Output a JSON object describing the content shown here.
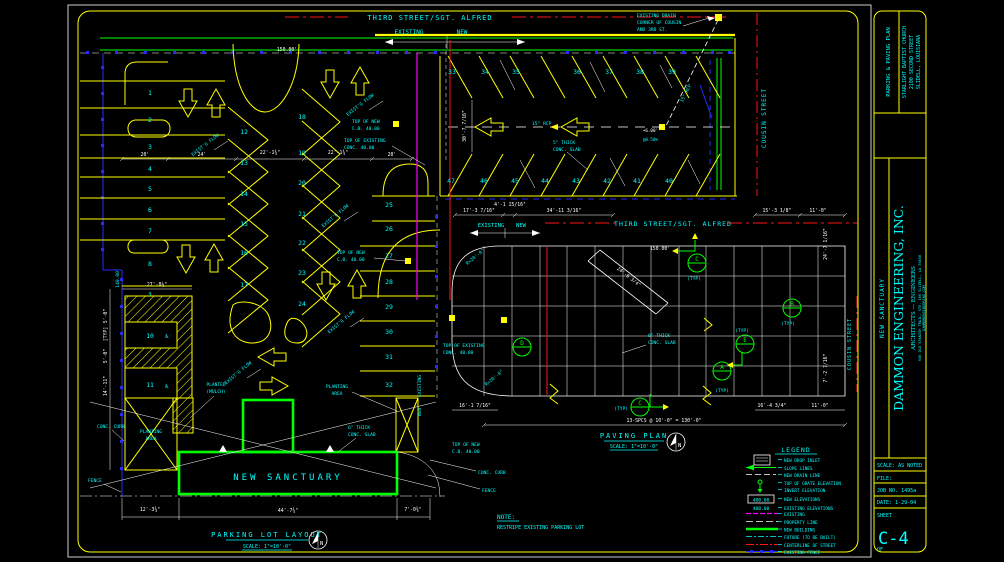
{
  "sheet": {
    "project": "PARKING & PAVING PLAN",
    "client": [
      "STARLIGHT BAPTIST CHURCH",
      "2100 SECOND STREET",
      "SLIDELL, LOUISIANA"
    ],
    "drawing": "NEW SANCTUARY",
    "firm": "DAMMON ENGINEERING, INC.",
    "firm_type": "ARCHITECTS — ENGINEERS",
    "firm_addr": "640 OLD SPANISH TRAIL, STE. 106   SLIDELL, LA 70458",
    "firm_site": "DAMMONENGINEERING.COM",
    "scale": "SCALE: AS NOTED",
    "file": "FILE:",
    "job": "JOB NO. 1495a",
    "date": "DATE: 1-29-04",
    "sheet_label": "SHEET",
    "sheet_no": "C-4",
    "of": "OF"
  },
  "streets": {
    "third": "THIRD STREET/SGT. ALFRED",
    "cousin": "COUSIN STREET",
    "existing": "EXISTING",
    "new_": "NEW"
  },
  "north": "N",
  "plan1": {
    "title": "PARKING LOT LAYOUT",
    "scale": "SCALE: 1\"=10'-0\"",
    "building": "NEW SANCTUARY",
    "handicap": "♿",
    "stalls": [
      "1",
      "2",
      "3",
      "4",
      "5",
      "6",
      "7",
      "8",
      "9",
      "10",
      "11",
      "12",
      "13",
      "14",
      "15",
      "16",
      "17",
      "18",
      "19",
      "20",
      "21",
      "22",
      "23",
      "24",
      "25",
      "26",
      "27",
      "28",
      "29",
      "30",
      "31",
      "32",
      "33",
      "34",
      "35",
      "36",
      "37",
      "38",
      "39",
      "40",
      "41",
      "42",
      "43",
      "44",
      "45",
      "46",
      "47"
    ],
    "labels": {
      "flow": "EXIST'G FLOW",
      "cb_new": [
        "TOP OF NEW",
        "C.B. 40.00"
      ],
      "conc_exist": [
        "TOP OF EXISTING",
        "CONC. 40.00"
      ],
      "drain": [
        "EXISTING DRAIN",
        "CORNER OF COUSIN",
        "AND 3RD ST."
      ],
      "rcp": "15\" RCP",
      "elev6": "+6.00'",
      "slope": "@0.50%",
      "slab5": [
        "5\" THICK",
        "CONC. SLAB"
      ],
      "slab6": [
        "6\" THICK",
        "CONC. SLAB"
      ],
      "planted": [
        "PLANTED",
        "(MULCH)"
      ],
      "planting": [
        "PLANTING",
        "AREA"
      ],
      "curb": "CONC. CURB",
      "fence": "FENCE",
      "len150": "150.00'",
      "len140": "140.00'"
    },
    "dims": {
      "d20": "20'",
      "d24": "24'",
      "d22": "22'-1¾\"",
      "d27": "27'-8½\"",
      "d5": "5'-0\"",
      "typ": "[TYP]",
      "d14": "14'-11\"",
      "d12": "12'-3¾\"",
      "d44": "44'-7¾\"",
      "d7": "7'-0¾\"",
      "d30": "30'-7 7/16\""
    }
  },
  "plan2": {
    "title": "PAVING PLAN",
    "scale": "SCALE: 1\"=10'-0\"",
    "dims": {
      "t17": "17'-3 7/16\"",
      "t4": "4'-1 15/16\"",
      "t34": "34'-11 3/16\"",
      "t15": "15'-3 1/8\"",
      "t11": "11'-0\"",
      "b16": "16'-1 7/16\"",
      "b16b": "16'-4 3/4\"",
      "spcs": "13-SPCS @ 10'-0\" = 130'-0\"",
      "diag": "24'-6 3/4\"",
      "r20": "R=20'-0\"",
      "rv24": "24'-7 1/16\"",
      "rv7": "7'-2 7/16\"",
      "len150": "150.00'"
    },
    "details": {
      "a": "A",
      "b": "B",
      "c": "C",
      "d": "D",
      "e": "E",
      "typ": "(TYP)"
    }
  },
  "legend": {
    "title": "LEGEND",
    "new_elev": "400.00",
    "exist_elev": "400.00",
    "items": [
      "NEW DROP INLET",
      "SLOPE LINES",
      "NEW DRAIN LINE",
      "TOP OF GRATE ELEVATION",
      "INVERT ELEVATION",
      "NEW ELEVATIONS",
      "EXISTING ELEVATIONS",
      "EXISTING",
      "PROPERTY LINE",
      "NEW BUILDING",
      "FUTURE (TO BE BUILT)",
      "CENTERLINE OF STREET",
      "EXISTING FENCE"
    ]
  },
  "note": {
    "heading": "NOTE:",
    "body": "RESTRIPE EXISTING PARKING LOT"
  }
}
